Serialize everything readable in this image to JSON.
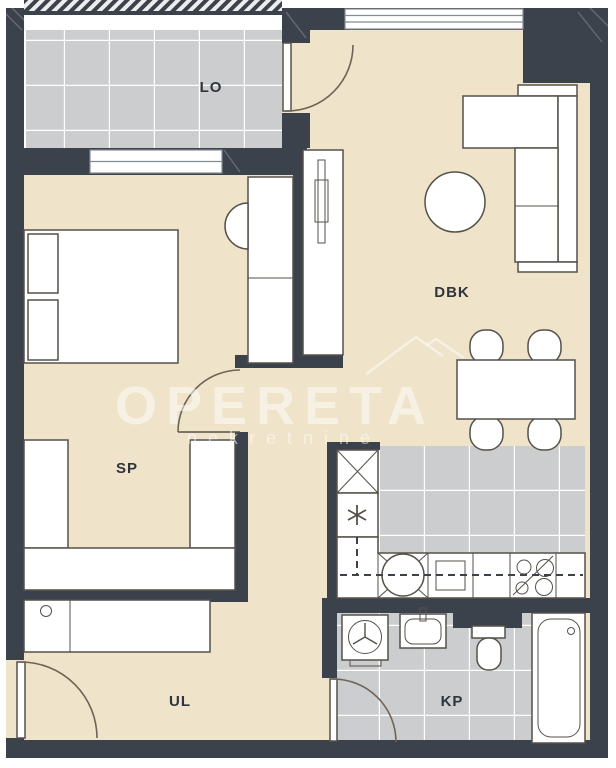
{
  "rooms": {
    "lo": {
      "label": "LO"
    },
    "dbk": {
      "label": "DBK"
    },
    "sp": {
      "label": "SP"
    },
    "ul": {
      "label": "UL"
    },
    "kp": {
      "label": "KP"
    }
  },
  "watermark": {
    "brand": "OPERETA",
    "subtitle": "nekretnine"
  },
  "colors": {
    "wall": "#3b424c",
    "floor": "#efe3c9",
    "tile": "#cbcdce",
    "grout": "#ffffff",
    "furniture": "#ffffff",
    "outline": "#55514a",
    "door": "#6e6455",
    "label": "#2f353c",
    "watermark": "rgba(255,255,255,0.5)",
    "window_frame": "#858b92"
  },
  "icons": {
    "shaft": "x-cross",
    "water_heater": "asterisk",
    "stove": "four-burner-circles",
    "kitchen_sink": "circle-in-square",
    "washing_machine": "drum-circle",
    "tv": "flat-bar",
    "bathtub_drain": "dot"
  }
}
